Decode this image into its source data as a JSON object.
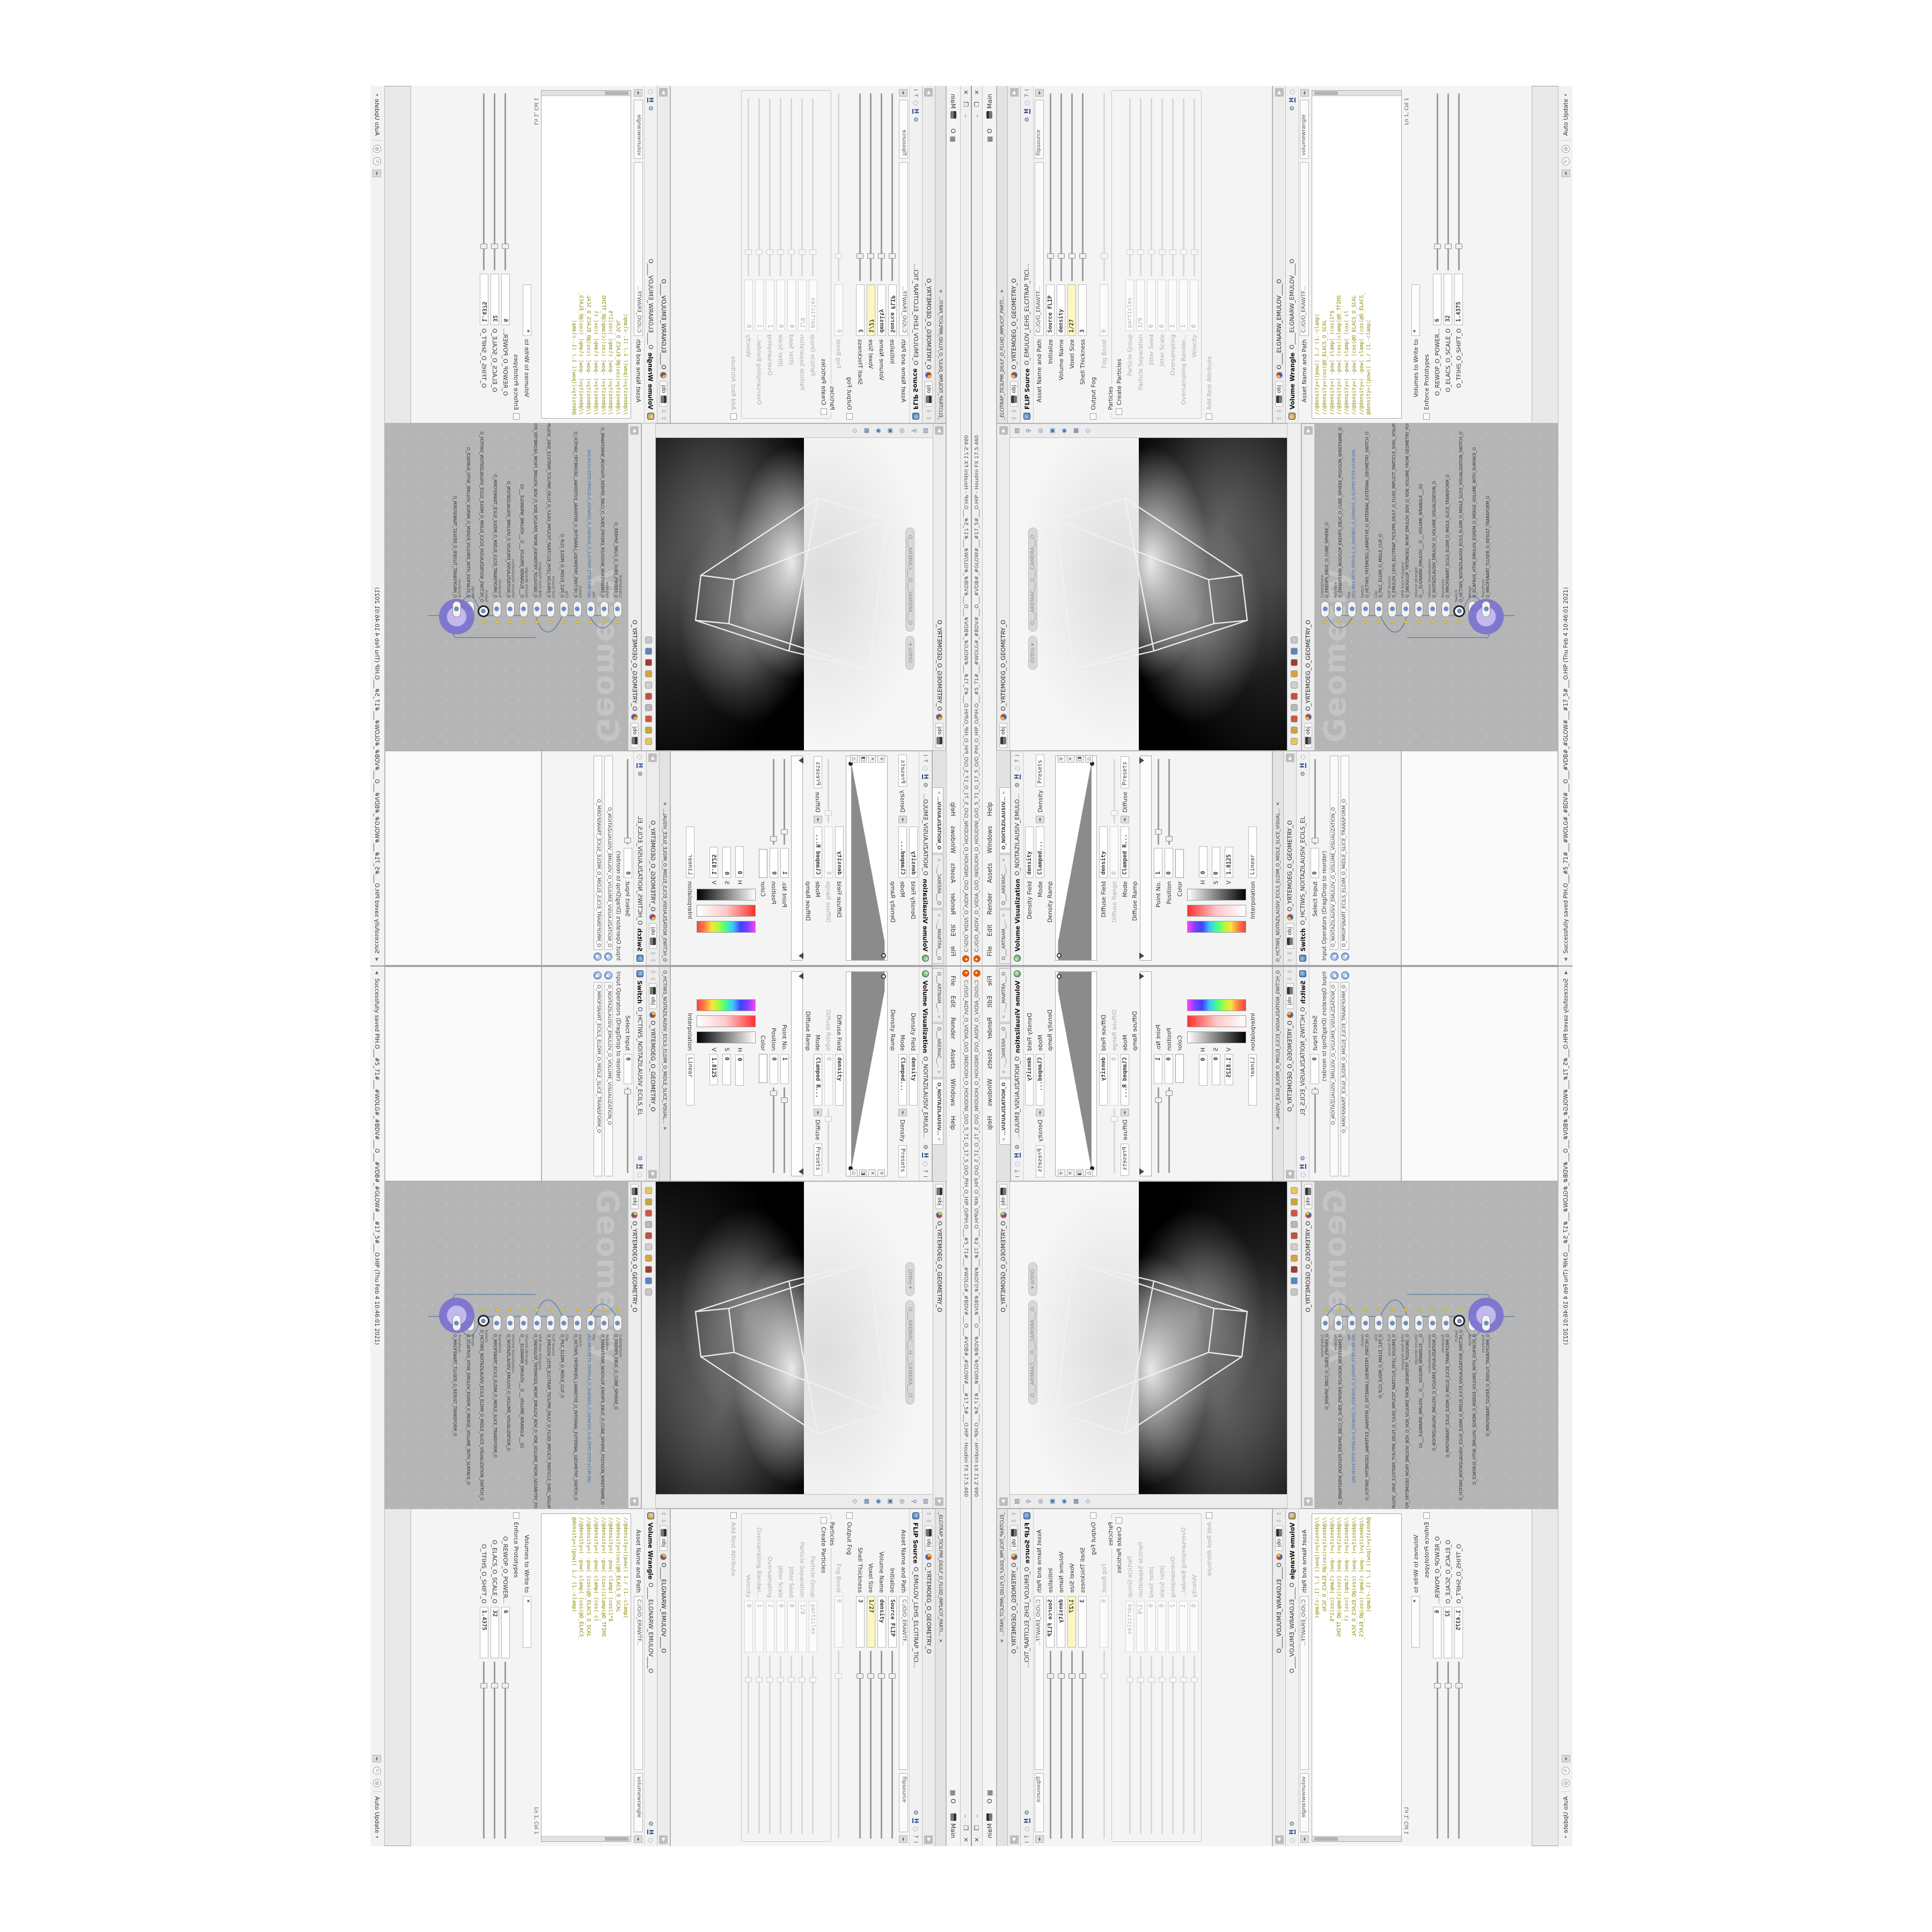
{
  "window": {
    "title": "C:/O/O_AIDIV_O_VIDIA_O/O_INIDUOH_O_HOUDINI_O/O_5_71_O_17_5_O/O_PIH_O_HIP_O/PIH.O___#5_71#___#WOLG#_#BDV#___O___#VDB#_#GLOW#___#17_5#___O.HIP - Houdini FX 17.5.460",
    "buttons": {
      "minimize": "–",
      "maximize": "❐",
      "close": "✕"
    }
  },
  "menu": {
    "items": [
      "File",
      "Edit",
      "Render",
      "Assets",
      "Windows",
      "Help"
    ],
    "desktop_o": "O",
    "desktop_main": "Main"
  },
  "left_tabs": [
    {
      "label": "O___ARTNAM__...",
      "cls": ""
    },
    {
      "label": "O___AREMAC__...",
      "cls": ""
    },
    {
      "label": "O_NOITAZILAUSIV...",
      "cls": "active"
    }
  ],
  "volviz": {
    "title": "Volume Visualization",
    "node": "O_NOITAZILAUSIV_EMULO...",
    "density_field_label": "Density Field",
    "density_field": "density",
    "mode_label": "Mode",
    "mode": "Clamped...",
    "mode_tab": "Density",
    "presets": "Presets",
    "density_ramp_label": "Density Ramp",
    "diffuse_field_label": "Diffuse Field",
    "diffuse_field": "density",
    "diffuse_range_label": "Diffuse Range",
    "diffuse_range": "0",
    "mode2_label": "Mode",
    "mode2": "Clamped R...",
    "mode2_tab": "Diffuse",
    "presets2": "Presets",
    "diffuse_ramp_label": "Diffuse Ramp",
    "point_label": "Point No.",
    "point": "1",
    "position_label": "Position",
    "position": "0",
    "color_label": "Color",
    "h_label": "H",
    "h": "0",
    "s_label": "S",
    "s": "0",
    "v_label": "V",
    "v": "1.8125",
    "interp_label": "Interpolation",
    "interp": "Linear"
  },
  "switch_pane": {
    "tab": "O_HCTIWS_NOITAZILAUSIV_ECILS_ELDIM_O_MIDLE_SLICE_VISUAL...",
    "path_tab": "obj",
    "path": "O_YRTEMOEG_O_GEOMETRY_O",
    "title": "Switch",
    "node": "O_HCTIWS_NOITAZILAUSIV_ECILS_EL",
    "select_label": "Select Input",
    "select_value": "0",
    "ops_label": "Input Operators (Drag/Drop to reorder)",
    "inputs": [
      {
        "name": "O_NOITAZILAUSIV_EMULOV_O_VOLUME_VISUALIZATION_O"
      },
      {
        "name": "O_MROFSNART_ECILS_ELDIM_O_MIDLE_SLICE_TRANSFORM_O"
      }
    ]
  },
  "viewport": {
    "path_tab": "obj",
    "path": "O_YRTEMOEG_O_GEOMETRY_O",
    "view_pill": "Ortho ▾",
    "camera_pill": "O___AREMAC___O___CAMERA___O"
  },
  "network": {
    "path_tab": "obj",
    "path": "O_YRTEMOEG_O_GEOMETRY_O",
    "watermark": "Geometry",
    "nodes": [
      {
        "type": "CubeSphere",
        "name": "O_EREHPS_EBUC_O_CUBE_SPHERE_O",
        "cls": ""
      },
      {
        "type": "PolyWire",
        "name": "O_EMARFERIW_NOGYLOP_EREHPS_EBUC_O_CUBE_SPHERE_POLYGON_WIREFRAME_O",
        "cls": ""
      },
      {
        "type": "File",
        "name": "JRD.M01.PETS.TRIPOLS_O_SISENEG_O_GENESIS_O.SLDPRT.STEP.101M.DRJ",
        "cls": "file"
      },
      {
        "type": "Switch",
        "name": "O_HCTIWS_YRTEMOEG_LANRETXE_O_INTERNAL_EXTERNAL_GEOMETRY_SWITCH_O",
        "cls": ""
      },
      {
        "type": "Clip",
        "name": "O_PILC_ELDIM_O_MIDLE_CLIP_O",
        "cls": ""
      },
      {
        "type": "FLIP Source",
        "name": "O_EMULOV_LEHS_ELCITRAP_TICILPMI_DIULF_O_FLUID_IMPLICIT_PARTICLE_SHEL_VOLUME_O",
        "cls": ""
      },
      {
        "type": "VDB from Polygons",
        "name": "O_SNOGILOP_YRTEMOEG_MORF_EMULOV_BDV_O_VDB_VOLUME_FROM_GEOMETRY_POLYGO...",
        "cls": ""
      },
      {
        "type": "Volume Wrangle",
        "name": "O___ELGNARW_EMULOV___O___VOLUME_WRANGLE___02",
        "cls": ""
      },
      {
        "type": "Volume Visualization",
        "name": "O_NOITAZILAUSIV_EMULOV_O_VOLUME_VISUALIZATION_O",
        "cls": ""
      },
      {
        "type": "Transform",
        "name": "O_MROFSNART_ECILS_ELDIM_O_MIDLE_SLICE_TRANSFORM_O",
        "cls": ""
      },
      {
        "type": "Switch",
        "name": "O_HCTIWS_NOITAZILAUSIV_ECILS_ELDIM_O_MIDLE_SLICE_VISUALIZATION_SWITCH_O",
        "cls": "dark"
      },
      {
        "type": "Merge",
        "name": "O_ECAFRUS_HTIW_EMULOV_EGREM_O_MERGE_VOLUME_WITH_SURFACE_O",
        "cls": ""
      },
      {
        "type": "Transform",
        "name": "O_MROFSNART_TLUSER_O_RESULT_TRANSFORM_O",
        "cls": "purple"
      }
    ]
  },
  "flip": {
    "tab": "_ELCITRAP_TICILPMI_DIULF_O_FLUID_IMPLICIT_PARTI...",
    "path_tab": "obj",
    "path": "O_YRTEMOEG_O_GEOMETRY_O",
    "title": "FLIP Source",
    "node": "O_EMULOV_LEHS_ELCITRAP_TICI...",
    "asset_label": "Asset Name and Path",
    "asset_path": "C:/O/O_ERAWTF...",
    "asset_name": "flipsource",
    "rows": [
      {
        "label": "Initialize",
        "value": "Source FLIP",
        "cls": ""
      },
      {
        "label": "Volume Name",
        "value": "density",
        "cls": ""
      },
      {
        "label": "Voxel Size",
        "value": "1/27",
        "cls": "yellow slider"
      },
      {
        "label": "Shell Thickness",
        "value": "3",
        "cls": "slider"
      },
      {
        "label": "Output Fog",
        "value": "",
        "cls": "chk"
      },
      {
        "label": "Fog Boost",
        "value": "0",
        "cls": "dis slider"
      }
    ],
    "group_label": "Particles",
    "particle_rows": [
      {
        "label": "Create Particles",
        "value": "",
        "cls": "chk"
      },
      {
        "label": "Particle Group",
        "value": "particles",
        "cls": "dis"
      },
      {
        "label": "Particle Separation",
        "value": "1/9",
        "cls": "dis slider"
      },
      {
        "label": "Jitter Seed",
        "value": "0",
        "cls": "dis slider"
      },
      {
        "label": "Jitter Scale",
        "value": "0",
        "cls": "dis slider"
      },
      {
        "label": "Oversampling",
        "value": "2",
        "cls": "dis slider"
      },
      {
        "label": "Oversampling Bandwi...",
        "value": "1",
        "cls": "dis slider"
      },
      {
        "label": "Velocity",
        "value": "0",
        "cls": "dis"
      }
    ],
    "rest_label": "Add Rest Attribute"
  },
  "wrangle": {
    "path_tab": "obj",
    "path": "O____ELGNARW_EMULOV____O",
    "title": "Volume Wrangle",
    "node": "O____ELGNARW_EMULOV____O",
    "asset_label": "Asset Name and Path",
    "asset_path": "C:/O/O_ERAWTF...",
    "asset_name": "volumewrangle",
    "code_lines": [
      {
        "t": "//@density=((pow(( 1./ (1.-clamp("
      },
      {
        "t": "//@density=(cos(@O_ELACS_O_SCAL"
      },
      {
        "t": "//@density=( -pow( clamp( (cos(1*$"
      },
      {
        "t": "//@density=( -pow( (cos((clamp(@O_TFIHS"
      },
      {
        "t": "//@density=( -pow( clamp( (cos( cl"
      },
      {
        "t": "//@density=( -pow( (cos(@O_ELACS_O_SCAL"
      },
      {
        "t": "//@density=( -pow( clamp( (cos(@O_ELACS_"
      },
      {
        "t": "@density=((pow(( 1./ (1.-clamp("
      }
    ],
    "lncol": "Ln 1, Col 1",
    "writeto_label": "Volumes to Write to",
    "writeto": "*",
    "enforce_label": "Enforce Prototypes",
    "sliders": [
      {
        "label": "O_REWOP_O_POWER...",
        "value": "6",
        "cls": "s1"
      },
      {
        "label": "O_ELACS_O_SCALE_O",
        "value": "32",
        "cls": "s2"
      },
      {
        "label": "O_TFIHS_O_SHIFT_O",
        "value": "1.4375",
        "cls": "s3"
      }
    ]
  },
  "status": {
    "message": "Successfully saved PIH.O___#5_71#___#WOLG#_#BDV#___O___#VDB#_#GLOW#___#17_5#___O.HIP (Thu Feb 4 10:46:01 2021)",
    "auto_update": "Auto Update"
  },
  "colors": {
    "field_highlight": "#fbf7c0",
    "code_olive": "#8a8a00",
    "code_keyword": "#167e7e",
    "network_bg": "#b5b5b5",
    "node_select_purple": "#7d74cf",
    "houdini_orange": "#e85d04",
    "viewport_bg_dark": "#000000",
    "viewport_bg_light": "#f6f6f6"
  }
}
